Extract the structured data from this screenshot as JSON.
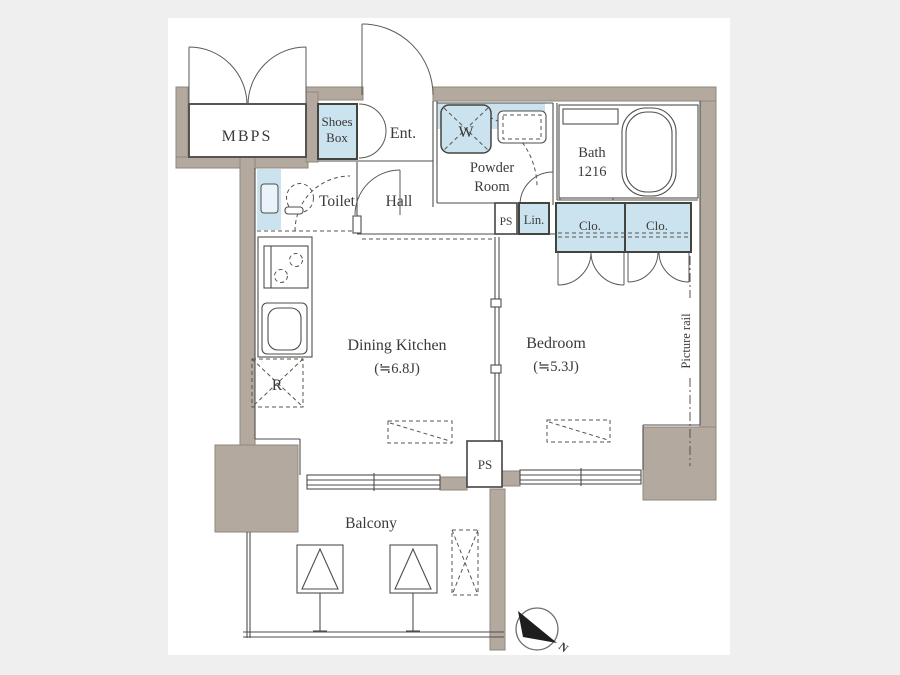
{
  "scene": {
    "kind": "apartment-floorplan",
    "colors": {
      "background": "#efeff0",
      "sheet": "#ffffff",
      "wall": "#b3a99f",
      "wall_edge": "#8f867c",
      "line": "#4f4e4a",
      "fixture_blue": "#cbe3ef",
      "text": "#3a3a38",
      "compass_arrow": "#1e1e1e"
    }
  },
  "labels": {
    "mbps": "MBPS",
    "shoes_box_line1": "Shoes",
    "shoes_box_line2": "Box",
    "entrance": "Ent.",
    "toilet": "Toilet",
    "hall": "Hall",
    "washer": "W",
    "powder_line1": "Powder",
    "powder_line2": "Room",
    "bath_line1": "Bath",
    "bath_line2": "1216",
    "ps_upper": "PS",
    "linen": "Lin.",
    "closet_left": "Clo.",
    "closet_right": "Clo.",
    "dining_kitchen_name": "Dining Kitchen",
    "dining_kitchen_size": "(≒6.8J)",
    "bedroom_name": "Bedroom",
    "bedroom_size": "(≒5.3J)",
    "refrigerator": "R",
    "ps_lower": "PS",
    "balcony": "Balcony",
    "picture_rail": "Picture rail",
    "compass_north": "N"
  }
}
